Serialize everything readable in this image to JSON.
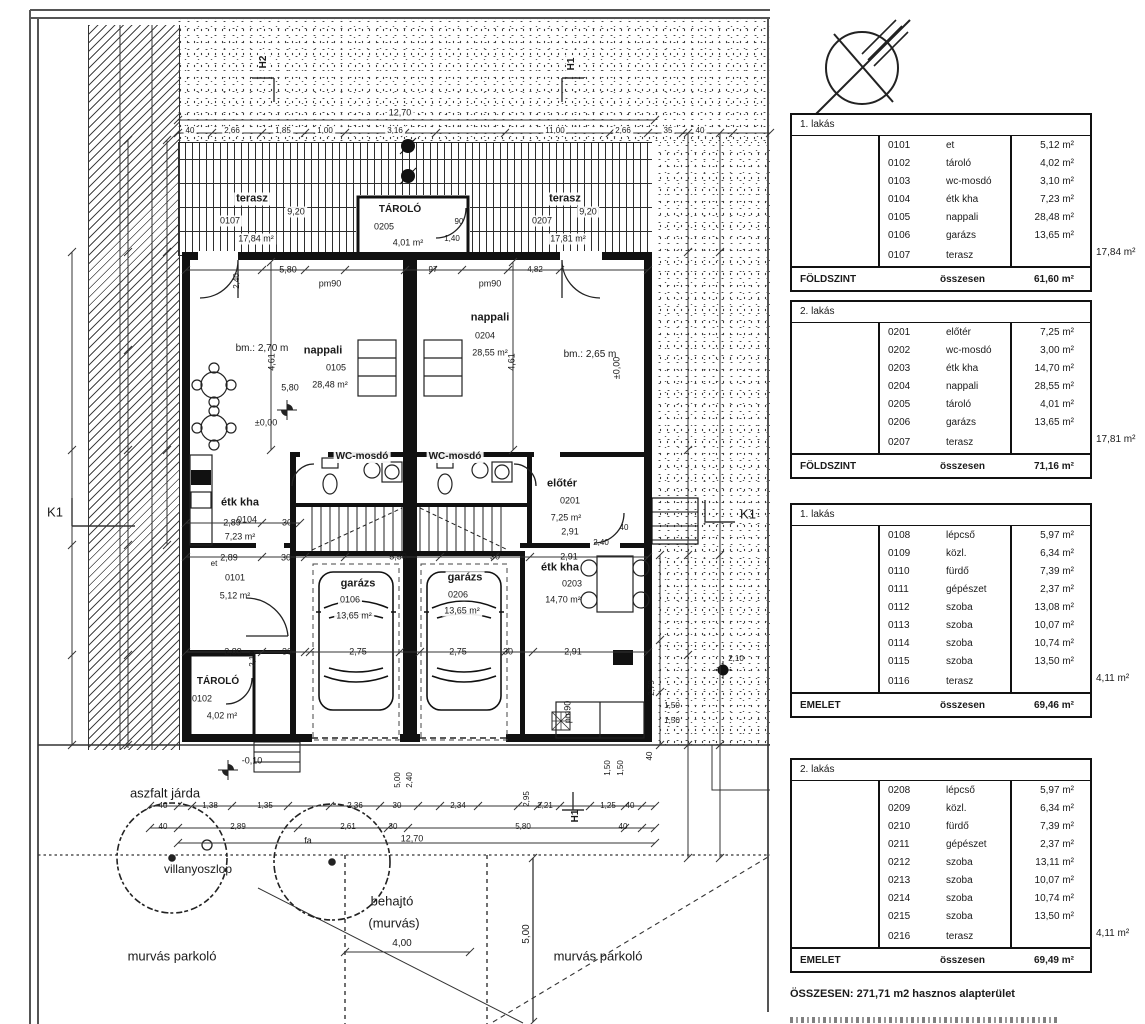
{
  "tables": [
    {
      "y": 113,
      "apartment": "1. lakás",
      "level": "FÖLDSZINT",
      "total_label": "összesen",
      "total": "61,60 m²",
      "outside": "17,84 m²",
      "rows": [
        [
          "0101",
          "et",
          "5,12 m²"
        ],
        [
          "0102",
          "tároló",
          "4,02 m²"
        ],
        [
          "0103",
          "wc-mosdó",
          "3,10 m²"
        ],
        [
          "0104",
          "étk kha",
          "7,23 m²"
        ],
        [
          "0105",
          "nappali",
          "28,48 m²"
        ],
        [
          "0106",
          "garázs",
          "13,65 m²"
        ],
        [
          "0107",
          "terasz",
          ""
        ]
      ]
    },
    {
      "y": 300,
      "apartment": "2. lakás",
      "level": "FÖLDSZINT",
      "total_label": "összesen",
      "total": "71,16 m²",
      "outside": "17,81 m²",
      "rows": [
        [
          "0201",
          "előtér",
          "7,25 m²"
        ],
        [
          "0202",
          "wc-mosdó",
          "3,00 m²"
        ],
        [
          "0203",
          "étk kha",
          "14,70 m²"
        ],
        [
          "0204",
          "nappali",
          "28,55 m²"
        ],
        [
          "0205",
          "tároló",
          "4,01 m²"
        ],
        [
          "0206",
          "garázs",
          "13,65 m²"
        ],
        [
          "0207",
          "terasz",
          ""
        ]
      ]
    },
    {
      "y": 503,
      "apartment": "1. lakás",
      "level": "EMELET",
      "total_label": "összesen",
      "total": "69,46 m²",
      "outside": "4,11 m²",
      "rows": [
        [
          "0108",
          "lépcső",
          "5,97 m²"
        ],
        [
          "0109",
          "közl.",
          "6,34 m²"
        ],
        [
          "0110",
          "fürdő",
          "7,39 m²"
        ],
        [
          "0111",
          "gépészet",
          "2,37 m²"
        ],
        [
          "0112",
          "szoba",
          "13,08 m²"
        ],
        [
          "0113",
          "szoba",
          "10,07 m²"
        ],
        [
          "0114",
          "szoba",
          "10,74 m²"
        ],
        [
          "0115",
          "szoba",
          "13,50 m²"
        ],
        [
          "0116",
          "terasz",
          ""
        ]
      ]
    },
    {
      "y": 758,
      "apartment": "2. lakás",
      "level": "EMELET",
      "total_label": "összesen",
      "total": "69,49 m²",
      "outside": "4,11 m²",
      "rows": [
        [
          "0208",
          "lépcső",
          "5,97 m²"
        ],
        [
          "0209",
          "közl.",
          "6,34 m²"
        ],
        [
          "0210",
          "fürdő",
          "7,39 m²"
        ],
        [
          "0211",
          "gépészet",
          "2,37 m²"
        ],
        [
          "0212",
          "szoba",
          "13,11 m²"
        ],
        [
          "0213",
          "szoba",
          "10,07 m²"
        ],
        [
          "0214",
          "szoba",
          "10,74 m²"
        ],
        [
          "0215",
          "szoba",
          "13,50 m²"
        ],
        [
          "0216",
          "terasz",
          ""
        ]
      ]
    }
  ],
  "summary": {
    "total_line": "ÖSSZESEN: 271,71 m2 hasznos alapterület"
  },
  "plan": {
    "labels": [
      {
        "t": "terasz",
        "x": 252,
        "y": 199,
        "s": 11,
        "b": 1,
        "bg": 1
      },
      {
        "t": "0107",
        "x": 230,
        "y": 221,
        "s": 9,
        "bg": 1
      },
      {
        "t": "9,20",
        "x": 296,
        "y": 212,
        "s": 9,
        "bg": 1
      },
      {
        "t": "17,84 m²",
        "x": 256,
        "y": 239,
        "s": 9,
        "bg": 1
      },
      {
        "t": "terasz",
        "x": 565,
        "y": 199,
        "s": 11,
        "b": 1,
        "bg": 1
      },
      {
        "t": "0207",
        "x": 542,
        "y": 221,
        "s": 9,
        "bg": 1
      },
      {
        "t": "9,20",
        "x": 588,
        "y": 212,
        "s": 9,
        "bg": 1
      },
      {
        "t": "17,81 m²",
        "x": 568,
        "y": 239,
        "s": 9,
        "bg": 1
      },
      {
        "t": "TÁROLÓ",
        "x": 400,
        "y": 210,
        "s": 10,
        "b": 1
      },
      {
        "t": "0205",
        "x": 384,
        "y": 227,
        "s": 9
      },
      {
        "t": "4,01 m²",
        "x": 408,
        "y": 243,
        "s": 9
      },
      {
        "t": "90",
        "x": 459,
        "y": 222,
        "s": 8
      },
      {
        "t": "1,40",
        "x": 452,
        "y": 239,
        "s": 8
      },
      {
        "t": "12,70",
        "x": 400,
        "y": 113,
        "s": 9,
        "bg": 1
      },
      {
        "t": "40",
        "x": 190,
        "y": 131,
        "s": 8,
        "bg": 1
      },
      {
        "t": "2,66",
        "x": 232,
        "y": 131,
        "s": 8,
        "bg": 1
      },
      {
        "t": "1,85",
        "x": 283,
        "y": 131,
        "s": 8,
        "bg": 1
      },
      {
        "t": "1,00",
        "x": 325,
        "y": 131,
        "s": 8,
        "bg": 1
      },
      {
        "t": "3,16",
        "x": 395,
        "y": 131,
        "s": 8,
        "bg": 1
      },
      {
        "t": "11,00",
        "x": 555,
        "y": 131,
        "s": 8,
        "bg": 1
      },
      {
        "t": "2,66",
        "x": 623,
        "y": 131,
        "s": 8,
        "bg": 1
      },
      {
        "t": "35",
        "x": 668,
        "y": 131,
        "s": 8,
        "bg": 1
      },
      {
        "t": "40",
        "x": 700,
        "y": 131,
        "s": 8,
        "bg": 1
      },
      {
        "t": "bm.: 2,70 m",
        "x": 262,
        "y": 349,
        "s": 10
      },
      {
        "t": "bm.: 2,65 m",
        "x": 590,
        "y": 355,
        "s": 10
      },
      {
        "t": "nappali",
        "x": 323,
        "y": 351,
        "s": 11,
        "b": 1
      },
      {
        "t": "0105",
        "x": 336,
        "y": 368,
        "s": 9
      },
      {
        "t": "28,48 m²",
        "x": 330,
        "y": 385,
        "s": 9
      },
      {
        "t": "nappali",
        "x": 490,
        "y": 318,
        "s": 11,
        "b": 1
      },
      {
        "t": "0204",
        "x": 485,
        "y": 336,
        "s": 9
      },
      {
        "t": "28,55 m²",
        "x": 490,
        "y": 353,
        "s": 9
      },
      {
        "t": "5,80",
        "x": 288,
        "y": 270,
        "s": 9
      },
      {
        "t": "97",
        "x": 433,
        "y": 270,
        "s": 8
      },
      {
        "t": "4,82",
        "x": 535,
        "y": 270,
        "s": 8
      },
      {
        "t": "pm90",
        "x": 330,
        "y": 284,
        "s": 9
      },
      {
        "t": "pm90",
        "x": 490,
        "y": 284,
        "s": 9
      },
      {
        "t": "2,40",
        "x": 237,
        "y": 281,
        "s": 8,
        "r": 1
      },
      {
        "t": "5,80",
        "x": 290,
        "y": 388,
        "s": 9
      },
      {
        "t": "4,61",
        "x": 272,
        "y": 362,
        "s": 9,
        "r": 1
      },
      {
        "t": "4,61",
        "x": 512,
        "y": 362,
        "s": 9,
        "r": 1
      },
      {
        "t": "±0,00",
        "x": 266,
        "y": 423,
        "s": 9
      },
      {
        "t": "±0,00",
        "x": 617,
        "y": 368,
        "s": 9,
        "r": 1
      },
      {
        "t": "WC-mosdó",
        "x": 362,
        "y": 457,
        "s": 10,
        "b": 1,
        "bg": 1
      },
      {
        "t": "WC-mosdó",
        "x": 455,
        "y": 457,
        "s": 10,
        "b": 1,
        "bg": 1
      },
      {
        "t": "étk kha",
        "x": 240,
        "y": 503,
        "s": 11,
        "b": 1
      },
      {
        "t": "0104",
        "x": 247,
        "y": 520,
        "s": 9
      },
      {
        "t": "7,23 m²",
        "x": 240,
        "y": 537,
        "s": 9
      },
      {
        "t": "előtér",
        "x": 562,
        "y": 484,
        "s": 11,
        "b": 1
      },
      {
        "t": "0201",
        "x": 570,
        "y": 501,
        "s": 9
      },
      {
        "t": "7,25 m²",
        "x": 566,
        "y": 518,
        "s": 9
      },
      {
        "t": "2,91",
        "x": 570,
        "y": 532,
        "s": 9
      },
      {
        "t": "2,40",
        "x": 601,
        "y": 543,
        "s": 8
      },
      {
        "t": "40",
        "x": 624,
        "y": 528,
        "s": 8
      },
      {
        "t": "2,89",
        "x": 232,
        "y": 523,
        "s": 9
      },
      {
        "t": "30",
        "x": 287,
        "y": 523,
        "s": 9
      },
      {
        "t": "2,89",
        "x": 229,
        "y": 558,
        "s": 9
      },
      {
        "t": "30",
        "x": 286,
        "y": 558,
        "s": 9
      },
      {
        "t": "5,50",
        "x": 398,
        "y": 557,
        "s": 9
      },
      {
        "t": "30",
        "x": 495,
        "y": 557,
        "s": 9
      },
      {
        "t": "2,91",
        "x": 569,
        "y": 557,
        "s": 9
      },
      {
        "t": "et",
        "x": 214,
        "y": 564,
        "s": 8
      },
      {
        "t": "0101",
        "x": 235,
        "y": 578,
        "s": 9
      },
      {
        "t": "5,12 m²",
        "x": 235,
        "y": 596,
        "s": 9
      },
      {
        "t": "garázs",
        "x": 358,
        "y": 584,
        "s": 11,
        "b": 1,
        "bg": 1
      },
      {
        "t": "0106",
        "x": 350,
        "y": 600,
        "s": 9,
        "bg": 1
      },
      {
        "t": "13,65 m²",
        "x": 354,
        "y": 616,
        "s": 9,
        "bg": 1
      },
      {
        "t": "garázs",
        "x": 465,
        "y": 578,
        "s": 11,
        "b": 1,
        "bg": 1
      },
      {
        "t": "0206",
        "x": 458,
        "y": 595,
        "s": 9,
        "bg": 1
      },
      {
        "t": "13,65 m²",
        "x": 462,
        "y": 611,
        "s": 9,
        "bg": 1
      },
      {
        "t": "étk kha",
        "x": 560,
        "y": 568,
        "s": 11,
        "b": 1
      },
      {
        "t": "0203",
        "x": 572,
        "y": 584,
        "s": 9
      },
      {
        "t": "14,70 m²",
        "x": 563,
        "y": 600,
        "s": 9
      },
      {
        "t": "2,89",
        "x": 233,
        "y": 652,
        "s": 9
      },
      {
        "t": "2,10",
        "x": 253,
        "y": 659,
        "s": 8,
        "r": 1
      },
      {
        "t": "30",
        "x": 287,
        "y": 652,
        "s": 9
      },
      {
        "t": "2,75",
        "x": 358,
        "y": 652,
        "s": 9
      },
      {
        "t": "2,75",
        "x": 458,
        "y": 652,
        "s": 9
      },
      {
        "t": "30",
        "x": 508,
        "y": 652,
        "s": 9
      },
      {
        "t": "2,91",
        "x": 573,
        "y": 652,
        "s": 9
      },
      {
        "t": "TÁROLÓ",
        "x": 218,
        "y": 682,
        "s": 10,
        "b": 1
      },
      {
        "t": "0102",
        "x": 202,
        "y": 699,
        "s": 9
      },
      {
        "t": "4,02 m²",
        "x": 222,
        "y": 716,
        "s": 9
      },
      {
        "t": "pm90",
        "x": 568,
        "y": 712,
        "s": 9,
        "r": 1
      },
      {
        "t": "1,50",
        "x": 672,
        "y": 706,
        "s": 8
      },
      {
        "t": "1,50",
        "x": 672,
        "y": 721,
        "s": 8
      },
      {
        "t": "1,50",
        "x": 608,
        "y": 768,
        "s": 8,
        "r": 1
      },
      {
        "t": "1,50",
        "x": 621,
        "y": 768,
        "s": 8,
        "r": 1
      },
      {
        "t": "2,79",
        "x": 652,
        "y": 688,
        "s": 8,
        "r": 1
      },
      {
        "t": "40",
        "x": 650,
        "y": 756,
        "s": 8,
        "r": 1
      },
      {
        "t": "2,10",
        "x": 736,
        "y": 659,
        "s": 8
      },
      {
        "t": "-0,10",
        "x": 252,
        "y": 761,
        "s": 9
      },
      {
        "t": "K1",
        "x": 55,
        "y": 512,
        "s": 13
      },
      {
        "t": "K1",
        "x": 748,
        "y": 514,
        "s": 13
      },
      {
        "t": "H2",
        "x": 264,
        "y": 62,
        "s": 10,
        "b": 1,
        "r": 1,
        "bg": 1
      },
      {
        "t": "H1",
        "x": 572,
        "y": 64,
        "s": 10,
        "b": 1,
        "r": 1,
        "bg": 1
      },
      {
        "t": "H1",
        "x": 576,
        "y": 816,
        "s": 10,
        "b": 1,
        "r": 1
      },
      {
        "t": "aszfalt járda",
        "x": 165,
        "y": 793,
        "s": 13
      },
      {
        "t": "villanyoszlop",
        "x": 198,
        "y": 869,
        "s": 12
      },
      {
        "t": "behajtó",
        "x": 392,
        "y": 901,
        "s": 13
      },
      {
        "t": "(murvás)",
        "x": 394,
        "y": 923,
        "s": 13
      },
      {
        "t": "murvás parkoló",
        "x": 172,
        "y": 956,
        "s": 13
      },
      {
        "t": "murvás parkoló",
        "x": 598,
        "y": 956,
        "s": 13
      },
      {
        "t": "4,00",
        "x": 402,
        "y": 944,
        "s": 10
      },
      {
        "t": "5,00",
        "x": 527,
        "y": 934,
        "s": 10,
        "r": 1
      },
      {
        "t": "5,00",
        "x": 398,
        "y": 780,
        "s": 8,
        "r": 1
      },
      {
        "t": "2,40",
        "x": 410,
        "y": 780,
        "s": 8,
        "r": 1
      },
      {
        "t": "12,70",
        "x": 412,
        "y": 839,
        "s": 9
      },
      {
        "t": "fa",
        "x": 308,
        "y": 841,
        "s": 9
      },
      {
        "t": "40",
        "x": 163,
        "y": 806,
        "s": 8
      },
      {
        "t": "1,38",
        "x": 210,
        "y": 806,
        "s": 8
      },
      {
        "t": "1,35",
        "x": 265,
        "y": 806,
        "s": 8
      },
      {
        "t": "2,36",
        "x": 355,
        "y": 806,
        "s": 8
      },
      {
        "t": "30",
        "x": 397,
        "y": 806,
        "s": 8
      },
      {
        "t": "2,34",
        "x": 458,
        "y": 806,
        "s": 8
      },
      {
        "t": "2,95",
        "x": 527,
        "y": 799,
        "s": 8,
        "r": 1
      },
      {
        "t": "2,21",
        "x": 545,
        "y": 806,
        "s": 8
      },
      {
        "t": "1,25",
        "x": 608,
        "y": 806,
        "s": 8
      },
      {
        "t": "40",
        "x": 630,
        "y": 806,
        "s": 8
      },
      {
        "t": "40",
        "x": 163,
        "y": 827,
        "s": 8
      },
      {
        "t": "2,89",
        "x": 238,
        "y": 827,
        "s": 8
      },
      {
        "t": "2,61",
        "x": 348,
        "y": 827,
        "s": 8
      },
      {
        "t": "30",
        "x": 393,
        "y": 827,
        "s": 8
      },
      {
        "t": "5,80",
        "x": 523,
        "y": 827,
        "s": 8
      },
      {
        "t": "40",
        "x": 623,
        "y": 827,
        "s": 8
      }
    ],
    "dims_h": [
      [
        120,
        178,
        655,
        [
          178,
          655
        ]
      ],
      [
        133,
        178,
        770,
        [
          178,
          212,
          262,
          305,
          345,
          405,
          436,
          505,
          560,
          610,
          648,
          683,
          702,
          733,
          770
        ]
      ],
      [
        270,
        186,
        648,
        [
          186,
          262,
          305,
          345,
          405,
          433,
          462,
          508,
          560,
          648
        ]
      ],
      [
        523,
        186,
        300,
        [
          186,
          262,
          300
        ]
      ],
      [
        557,
        186,
        648,
        [
          186,
          262,
          305,
          345,
          440,
          495,
          530,
          648
        ]
      ],
      [
        652,
        186,
        648,
        [
          186,
          262,
          305,
          310,
          400,
          420,
          505,
          533,
          648
        ]
      ],
      [
        806,
        150,
        655,
        [
          150,
          178,
          192,
          232,
          288,
          330,
          380,
          418,
          440,
          478,
          518,
          538,
          560,
          590,
          625,
          642,
          655
        ]
      ],
      [
        828,
        150,
        655,
        [
          150,
          178,
          298,
          388,
          408,
          625,
          642,
          655
        ]
      ],
      [
        843,
        178,
        655,
        [
          178,
          655
        ]
      ],
      [
        952,
        345,
        470,
        [
          345,
          470
        ]
      ]
    ],
    "dims_v": [
      [
        72,
        252,
        745,
        [
          252,
          450,
          545,
          655,
          745
        ]
      ],
      [
        128,
        140,
        748,
        [
          140,
          252,
          350,
          450,
          545,
          655,
          745
        ]
      ],
      [
        167,
        140,
        545,
        [
          140,
          252,
          450,
          545
        ]
      ],
      [
        271,
        262,
        450,
        [
          262,
          450
        ]
      ],
      [
        513,
        262,
        450,
        [
          262,
          450
        ]
      ],
      [
        660,
        555,
        745,
        [
          555,
          640,
          692,
          745
        ]
      ],
      [
        688,
        133,
        858,
        [
          133,
          252,
          450,
          555,
          655,
          745,
          858
        ]
      ],
      [
        720,
        133,
        858,
        [
          133,
          252,
          555,
          745,
          858
        ]
      ],
      [
        533,
        858,
        1022,
        [
          858,
          1022
        ]
      ]
    ]
  }
}
